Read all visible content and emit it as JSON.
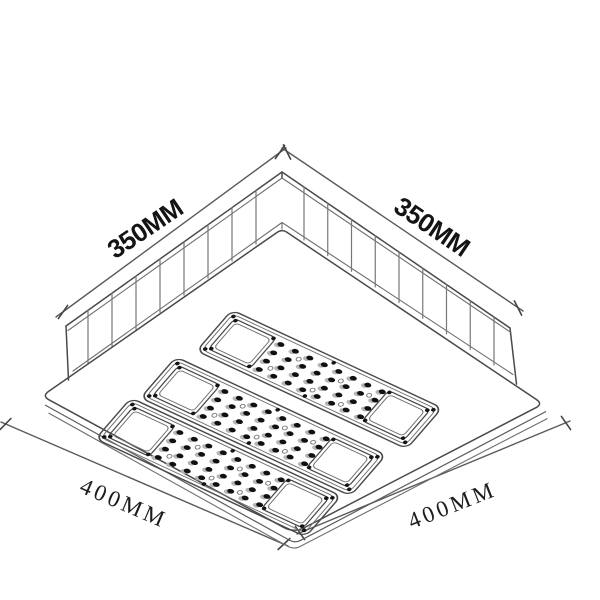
{
  "diagram": {
    "type": "isometric-technical-drawing",
    "subject": "recessed LED canopy light fixture",
    "dimensions": {
      "top_left": "350MM",
      "top_right": "350MM",
      "bottom_left": "400MM",
      "bottom_right": "400MM"
    },
    "modules": {
      "count": 3,
      "led_rows": 4,
      "led_cols": 8
    },
    "fins": {
      "left": 8,
      "right": 9
    },
    "colors": {
      "line": "#4a4a4a",
      "thin_line": "#6f6f6f",
      "dimension_line": "#5a5a5a",
      "text": "#141414",
      "led": "#101010",
      "led_base": "#b5b5b5",
      "background": "#ffffff"
    }
  }
}
